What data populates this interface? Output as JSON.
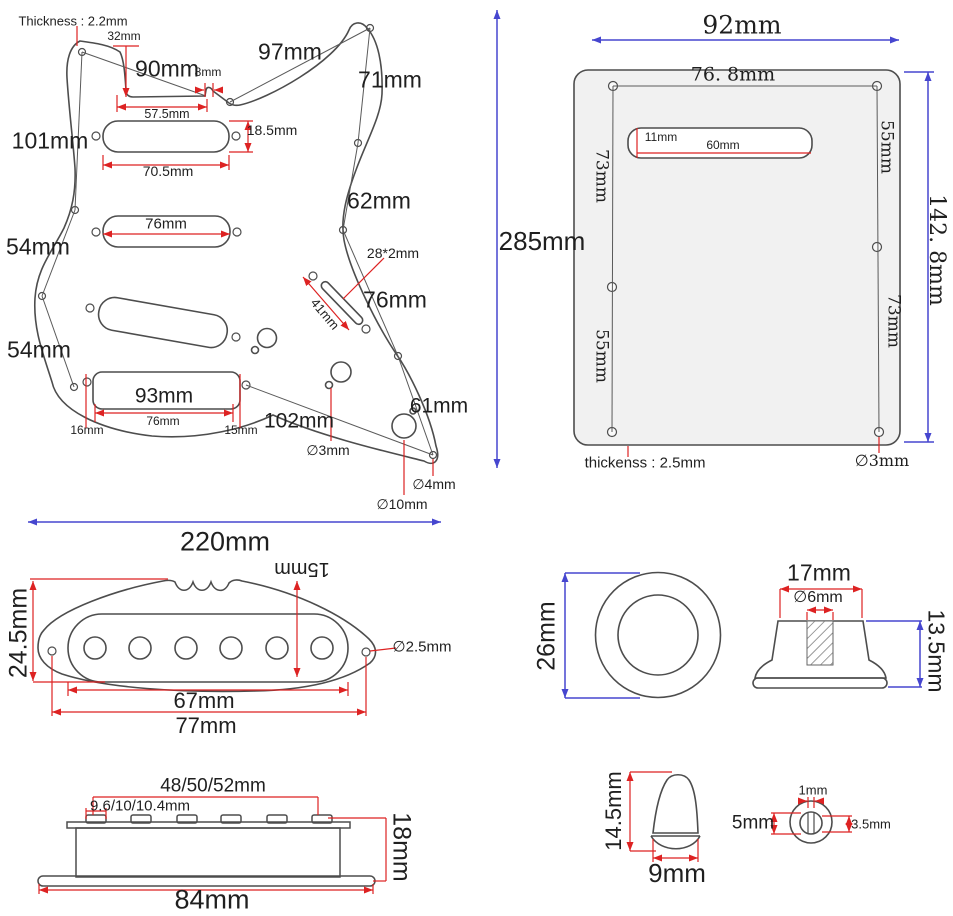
{
  "colors": {
    "outline": "#4d4d4d",
    "dim_red": "#dd2222",
    "dim_blue": "#4646cf",
    "plate_fill": "#f1f1f1",
    "text": "#1f1f1f"
  },
  "pickguard": {
    "thickness_note": "Thickness : 2.2mm",
    "d32": "32mm",
    "d90": "90mm",
    "d8": "8mm",
    "d57_5": "57.5mm",
    "d97": "97mm",
    "d71": "71mm",
    "d101": "101mm",
    "d18_5": "18.5mm",
    "d70_5": "70.5mm",
    "d76_mid": "76mm",
    "d62": "62mm",
    "d54_upper": "54mm",
    "d54_lower": "54mm",
    "d28x2": "28*2mm",
    "d41": "41mm",
    "d76_right": "76mm",
    "d93": "93mm",
    "d76_bridge": "76mm",
    "d16": "16mm",
    "d15": "15mm",
    "d102": "102mm",
    "d61": "61mm",
    "hole_3": "∅3mm",
    "hole_4": "∅4mm",
    "hole_10": "∅10mm",
    "width": "220mm",
    "height": "285mm"
  },
  "backplate": {
    "width": "92mm",
    "height": "142. 8mm",
    "screw_span": "76. 8mm",
    "slot_height": "11mm",
    "slot_width": "60mm",
    "left_upper": "73mm",
    "left_lower": "55mm",
    "right_upper": "55mm",
    "right_lower": "73mm",
    "thickness_note": "thickenss : 2.5mm",
    "hole": "∅3mm"
  },
  "pickup_cover": {
    "height": "24.5mm",
    "slot_height": "15mm",
    "hole": "∅2.5mm",
    "inner_width": "67mm",
    "outer_width": "77mm"
  },
  "pickup_side": {
    "pole_spread": "48/50/52mm",
    "pole_pitch": "9.6/10/10.4mm",
    "height": "18mm",
    "base_width": "84mm"
  },
  "knob": {
    "diameter": "26mm",
    "top_width": "17mm",
    "shaft": "∅6mm",
    "height": "13.5mm"
  },
  "switch_tip": {
    "height": "14.5mm",
    "width": "9mm",
    "slot_width": "1mm",
    "hole": "5mm",
    "inner": "3.5mm"
  }
}
